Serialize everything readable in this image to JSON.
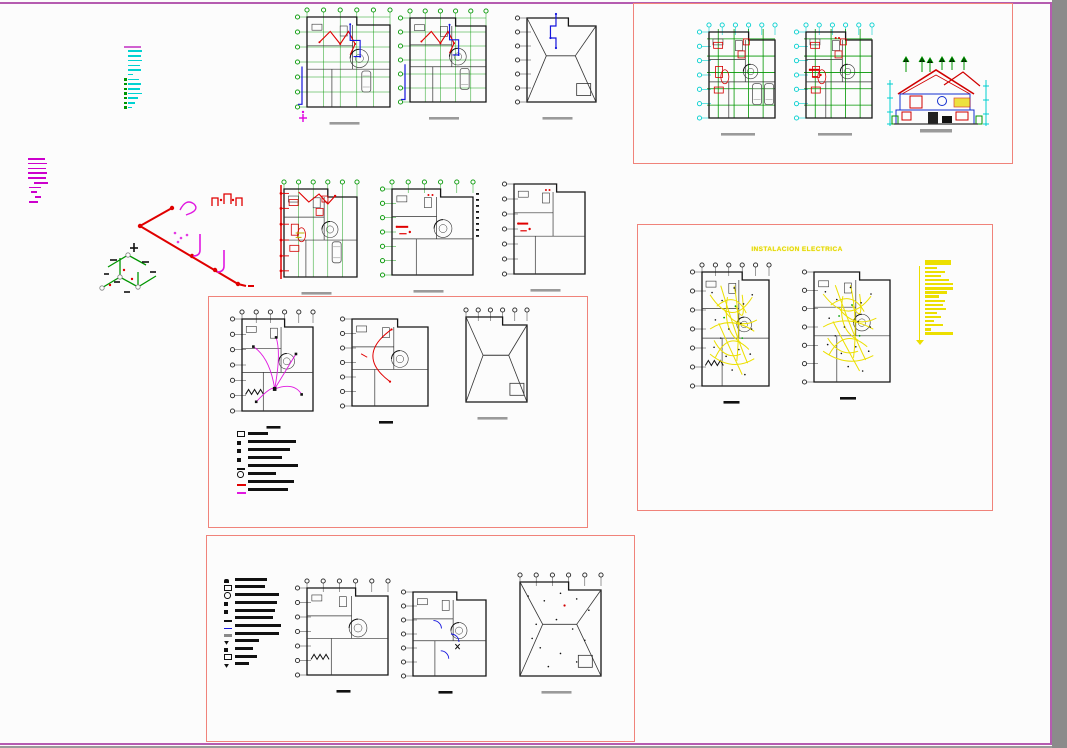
{
  "workspace": {
    "background": "#fcfcfc",
    "border_color": "#b55cb0",
    "side_strip_color": "#8b8b8b",
    "frame_border_color": "#f0837a"
  },
  "colors": {
    "grid_green": "#009600",
    "cyan": "#00cfcf",
    "red": "#e00000",
    "blue": "#1414dd",
    "magenta": "#e018e0",
    "yellow": "#ecdf00",
    "black_ink": "#161616",
    "gray_bar": "#9a9a9a"
  },
  "electrical": {
    "title": "INSTALACION ELECTRICA"
  },
  "notes": {
    "cyan": {
      "x": 124,
      "y": 46,
      "gap": 2.2,
      "lineColor": "#00d2d2",
      "tickColor": "#009600",
      "header": {
        "c": "#d060d0",
        "w": 17,
        "h": 2
      },
      "rows": [
        {
          "w": 14
        },
        {
          "w": 13
        },
        {
          "w": 14
        },
        {
          "w": 12
        },
        {
          "w": 13
        },
        {
          "w": 5
        },
        {
          "w": 11,
          "t": 1
        },
        {
          "w": 13,
          "t": 1
        },
        {
          "w": 12,
          "t": 1
        },
        {
          "w": 14,
          "t": 1
        },
        {
          "w": 10,
          "t": 1
        },
        {
          "w": 7,
          "t": 1
        },
        {
          "w": 4,
          "t": 1
        }
      ]
    },
    "magenta": {
      "x": 28,
      "y": 158,
      "gap": 3.2,
      "lineColor": "#cc00cc",
      "rows": [
        {
          "w": 17
        },
        {
          "w": 19
        },
        {
          "w": 18
        },
        {
          "w": 19
        },
        {
          "w": 18
        },
        {
          "w": 14,
          "i": 6
        },
        {
          "w": 12,
          "i": 1
        },
        {
          "w": 6,
          "i": 3
        },
        {
          "w": 6,
          "i": 7
        },
        {
          "w": 9,
          "i": 1
        }
      ]
    }
  },
  "legends": {
    "mid": {
      "x": 237,
      "y": 431,
      "gap": 3.6,
      "rows": [
        {
          "sym": "dsq",
          "w": 20
        },
        {
          "sym": "sq",
          "w": 48
        },
        {
          "sym": "sq",
          "w": 42
        },
        {
          "sym": "sq",
          "w": 34
        },
        {
          "sym": "dash",
          "w": 50
        },
        {
          "sym": "circ",
          "w": 28
        },
        {
          "sym": "rdash",
          "w": 46
        },
        {
          "sym": "mdash",
          "w": 40
        }
      ]
    },
    "bottom": {
      "x": 224,
      "y": 577,
      "gap": 3.2,
      "rows": [
        {
          "sym": "fan",
          "w": 32
        },
        {
          "sym": "dsq",
          "w": 30
        },
        {
          "sym": "circ",
          "w": 44
        },
        {
          "sym": "sq",
          "w": 42
        },
        {
          "sym": "sq",
          "w": 40
        },
        {
          "sym": "dash",
          "w": 38
        },
        {
          "sym": "bdash",
          "w": 46
        },
        {
          "sym": "grect",
          "w": 44
        },
        {
          "sym": "v",
          "w": 24
        },
        {
          "sym": "sq",
          "w": 18
        },
        {
          "sym": "dsq",
          "w": 22
        },
        {
          "sym": "v",
          "w": 14
        }
      ]
    },
    "yellow": {
      "x": 916,
      "y": 260,
      "color": "#ecdf00",
      "bars": [
        {
          "w": 26,
          "h": 5
        },
        {
          "w": 12
        },
        {
          "w": 20
        },
        {
          "w": 16
        },
        {
          "w": 24
        },
        {
          "w": 28
        },
        {
          "w": 28
        },
        {
          "w": 22
        },
        {
          "w": 14
        },
        {
          "w": 20
        },
        {
          "w": 18
        },
        {
          "w": 21
        },
        {
          "w": 12
        },
        {
          "w": 16
        },
        {
          "w": 9
        },
        {
          "w": 18
        },
        {
          "w": 6
        },
        {
          "w": 28
        }
      ]
    }
  },
  "plans": {
    "p1": {
      "x": 293,
      "y": 5,
      "w": 103,
      "h": 122,
      "grid": "green",
      "gridSide": "both",
      "gridFull": true,
      "overlay": "redblue",
      "magriser": true,
      "car": 1,
      "spiral": true,
      "sb": "g"
    },
    "p2": {
      "x": 396,
      "y": 6,
      "w": 96,
      "h": 116,
      "grid": "green",
      "gridSide": "both",
      "gridFull": true,
      "overlay": "redblue",
      "car": 1,
      "spiral": true,
      "sb": "g"
    },
    "p3": {
      "x": 513,
      "y": 6,
      "w": 89,
      "h": 116,
      "grid": "black",
      "gridSide": "left",
      "roof": true,
      "overlay": "bluetop",
      "sb": "g"
    },
    "p4": {
      "x": 695,
      "y": 20,
      "w": 86,
      "h": 118,
      "grid": "cyangreen",
      "overlay": "none",
      "furniture": true,
      "car": 2,
      "spiral": true,
      "sb": "g",
      "sbw": 34
    },
    "p5": {
      "x": 792,
      "y": 20,
      "w": 86,
      "h": 118,
      "grid": "cyangreen",
      "overlay": "redspots",
      "furniture": true,
      "spiral": true,
      "sb": "g",
      "sbw": 34
    },
    "p6": {
      "x": 270,
      "y": 177,
      "w": 93,
      "h": 120,
      "grid": "green",
      "gridSide": "top",
      "gridFull": true,
      "overlay": "redleft",
      "furniture": true,
      "car": 1,
      "spiral": true,
      "sb": "g"
    },
    "p7": {
      "x": 378,
      "y": 177,
      "w": 101,
      "h": 118,
      "grid": "green",
      "gridSide": "both",
      "overlay": "redspots",
      "rightbars": true,
      "spiral": true,
      "sb": "g"
    },
    "p8": {
      "x": 500,
      "y": 172,
      "w": 91,
      "h": 122,
      "grid": "black",
      "gridSide": "left",
      "overlay": "redspots",
      "sb": "g"
    },
    "p9": {
      "x": 228,
      "y": 307,
      "w": 91,
      "h": 124,
      "grid": "black",
      "gridSide": "both",
      "overlay": "magwires",
      "www": true,
      "spiral": true,
      "sb": "k",
      "sbw": 14
    },
    "p10": {
      "x": 338,
      "y": 307,
      "w": 96,
      "h": 119,
      "grid": "black",
      "gridSide": "left",
      "overlay": "redarc",
      "spiral": true,
      "sb": "k",
      "sbw": 14
    },
    "p11": {
      "x": 452,
      "y": 305,
      "w": 81,
      "h": 117,
      "grid": "black",
      "gridSide": "top",
      "roof": true,
      "overlay": "none",
      "sb": "g"
    },
    "p12": {
      "x": 688,
      "y": 260,
      "w": 87,
      "h": 146,
      "grid": "black",
      "gridSide": "both",
      "overlay": "yellow",
      "www": true,
      "spiral": true,
      "sb": "k",
      "sbw": 16
    },
    "p13": {
      "x": 800,
      "y": 260,
      "w": 96,
      "h": 142,
      "grid": "black",
      "gridSide": "left",
      "overlay": "yellow",
      "spiral": true,
      "sb": "k",
      "sbw": 16
    },
    "p14": {
      "x": 293,
      "y": 576,
      "w": 101,
      "h": 119,
      "grid": "black",
      "gridSide": "both",
      "overlay": "none",
      "www": true,
      "spiral": true,
      "sb": "k",
      "sbw": 14
    },
    "p15": {
      "x": 399,
      "y": 580,
      "w": 93,
      "h": 116,
      "grid": "black",
      "gridSide": "left",
      "overlay": "bluearcs",
      "spiral": true,
      "sb": "k",
      "sbw": 14
    },
    "p16": {
      "x": 506,
      "y": 570,
      "w": 101,
      "h": 126,
      "grid": "black",
      "gridSide": "top",
      "roof": true,
      "overlay": "dots",
      "reddot": true,
      "sb": "g"
    }
  }
}
